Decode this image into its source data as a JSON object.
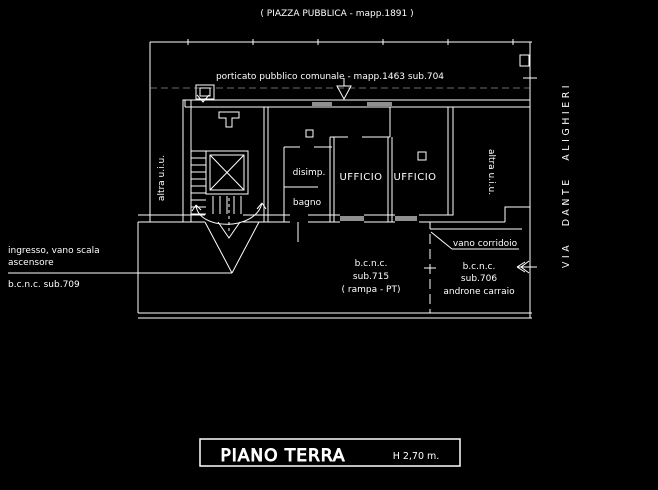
{
  "colors": {
    "background": "#000000",
    "line": "#ffffff",
    "dim_line": "#8f8f8f"
  },
  "header": {
    "piazza_label": "( PIAZZA PUBBLICA - mapp.1891 )",
    "porticato_label": "porticato pubblico comunale - mapp.1463 sub.704"
  },
  "plan": {
    "rooms": {
      "left_unit": "altra u.i.u.",
      "right_unit": "altra u.i.u.",
      "disimpegno": "disimp.",
      "bagno": "bagno",
      "office_1": "UFFICIO",
      "office_2": "UFFICIO"
    },
    "annotations": {
      "entrance_line1": "ingresso, vano scala",
      "entrance_line2": "ascensore",
      "entrance_sub": "b.c.n.c.  sub.709",
      "ramp_line1": "b.c.n.c.",
      "ramp_line2": "sub.715",
      "ramp_line3": "( rampa - PT)",
      "corridor_label": "vano corridoio",
      "driveway_line1": "b.c.n.c.",
      "driveway_line2": "sub.706",
      "driveway_line3": "androne carraio",
      "street_label": "VIA DANTE ALIGHIERI"
    }
  },
  "title_block": {
    "title": "PIANO TERRA",
    "height_note": "H 2,70 m."
  }
}
